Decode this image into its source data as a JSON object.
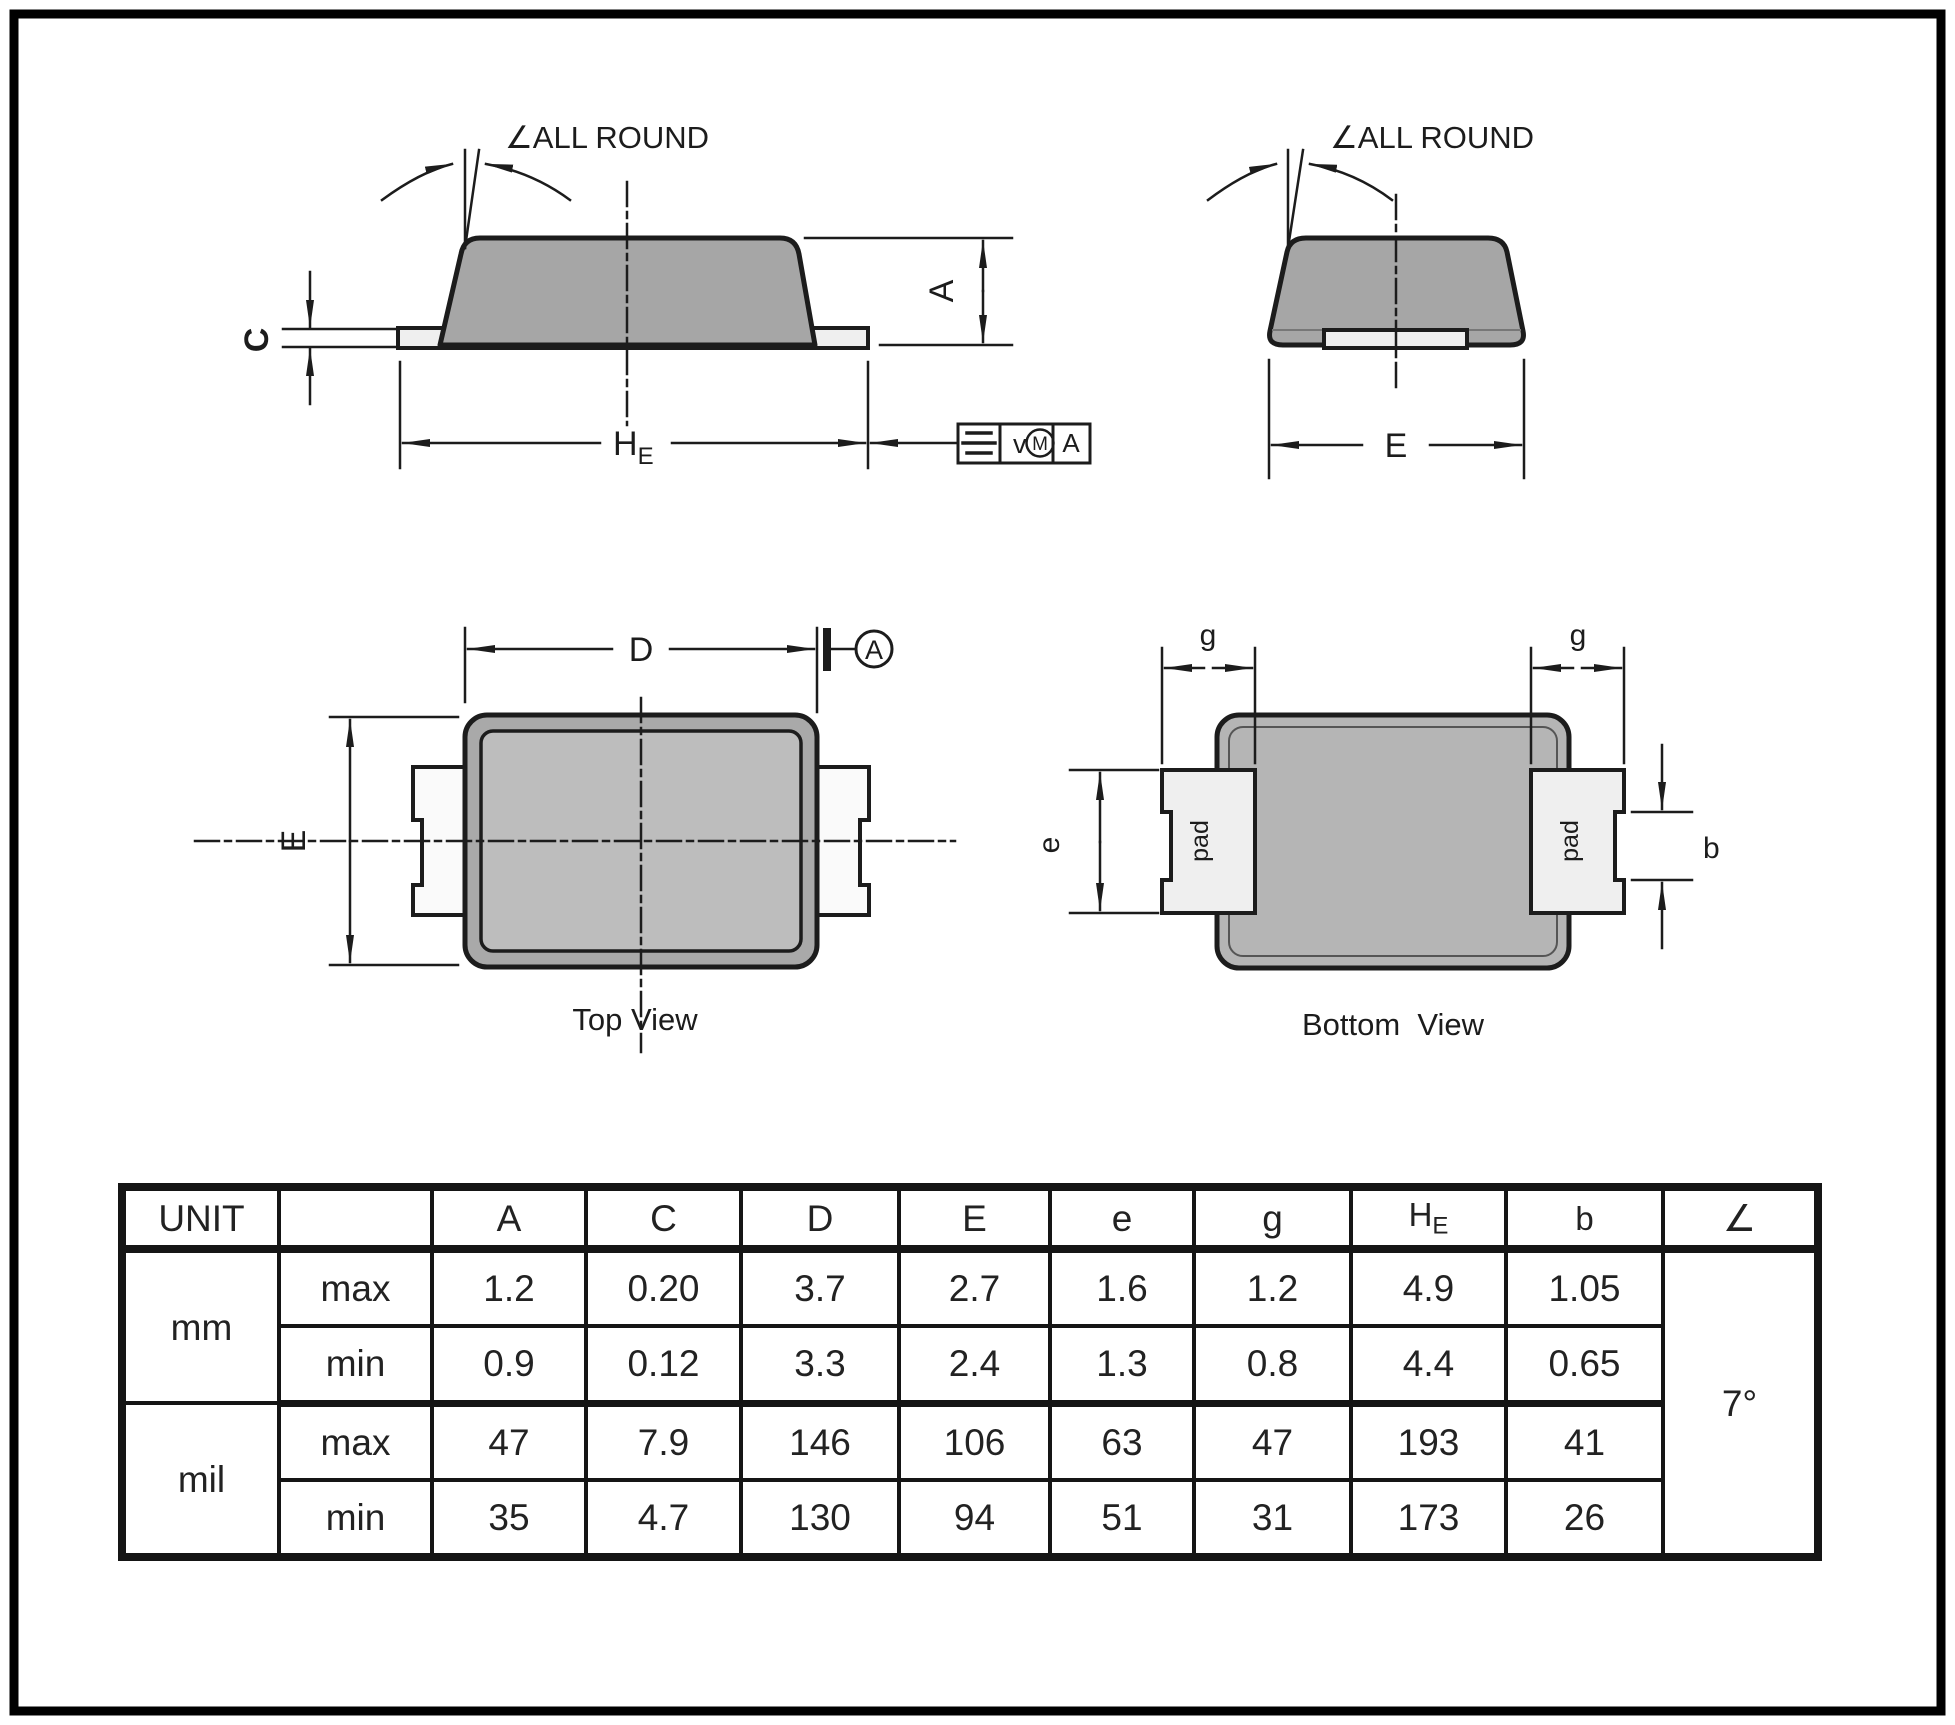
{
  "colors": {
    "line": "#1c1c1c",
    "body_gray": "#a6a6a6",
    "body_gray_light": "#bdbdbd",
    "bottom_body_gray": "#b5b5b5",
    "pad_light": "#efefef",
    "lead_white": "#fafafa",
    "background": "#ffffff"
  },
  "side_view": {
    "all_round": "∠ALL ROUND",
    "dim_c": "C",
    "dim_a": "A",
    "dim_he_main": "H",
    "dim_he_sub": "E",
    "fcf": {
      "symbol_icon": "symmetry-icon",
      "value": "v",
      "modifier": "M",
      "datum": "A"
    }
  },
  "end_view": {
    "all_round": "∠ALL ROUND",
    "dim_e": "E"
  },
  "top_view": {
    "title": "Top View",
    "dim_d": "D",
    "dim_e": "E",
    "datum_label": "A"
  },
  "bottom_view": {
    "title": "Bottom  View",
    "dim_g_left": "g",
    "dim_g_right": "g",
    "dim_e": "e",
    "dim_b": "b",
    "pad_left": "pad",
    "pad_right": "pad"
  },
  "table": {
    "unit_header": "UNIT",
    "columns": [
      {
        "label": "A"
      },
      {
        "label": "C"
      },
      {
        "label": "D"
      },
      {
        "label": "E"
      },
      {
        "label": "e"
      },
      {
        "label": "g"
      },
      {
        "label": "H",
        "sub": "E"
      },
      {
        "label": "b"
      },
      {
        "label": "∠"
      }
    ],
    "rows": [
      {
        "unit": "mm",
        "limit": "max",
        "values": [
          "1.2",
          "0.20",
          "3.7",
          "2.7",
          "1.6",
          "1.2",
          "4.9",
          "1.05"
        ]
      },
      {
        "unit": "mm",
        "limit": "min",
        "values": [
          "0.9",
          "0.12",
          "3.3",
          "2.4",
          "1.3",
          "0.8",
          "4.4",
          "0.65"
        ]
      },
      {
        "unit": "mil",
        "limit": "max",
        "values": [
          "47",
          "7.9",
          "146",
          "106",
          "63",
          "47",
          "193",
          "41"
        ]
      },
      {
        "unit": "mil",
        "limit": "min",
        "values": [
          "35",
          "4.7",
          "130",
          "94",
          "51",
          "31",
          "173",
          "26"
        ]
      }
    ],
    "angle_value": "7°"
  }
}
